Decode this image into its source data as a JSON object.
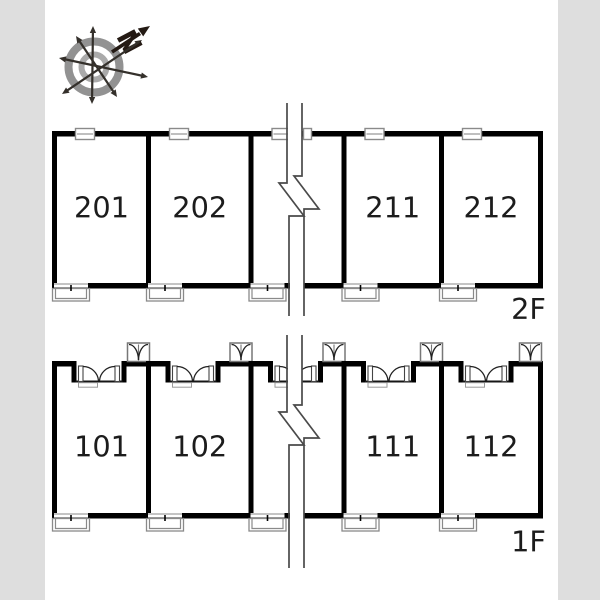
{
  "compass": {
    "north_label": "N"
  },
  "floors": [
    {
      "label": "2F",
      "rooms": [
        {
          "number": "201"
        },
        {
          "number": "202"
        },
        {
          "number": "211"
        },
        {
          "number": "212"
        }
      ]
    },
    {
      "label": "1F",
      "rooms": [
        {
          "number": "101"
        },
        {
          "number": "102"
        },
        {
          "number": "111"
        },
        {
          "number": "112"
        }
      ]
    }
  ],
  "colors": {
    "wall": "#000000",
    "thin_line": "#8a8a8a",
    "door_line": "#222222",
    "break_line": "#4a4a4a",
    "label_text": "#1c1c1c",
    "compass_arrow": "#241a14",
    "compass_needle": "#34302b",
    "compass_ring_outer": "#929292",
    "compass_ring_inner": "#aaaaaa",
    "page_margin": "#dedede",
    "background": "#ffffff"
  }
}
